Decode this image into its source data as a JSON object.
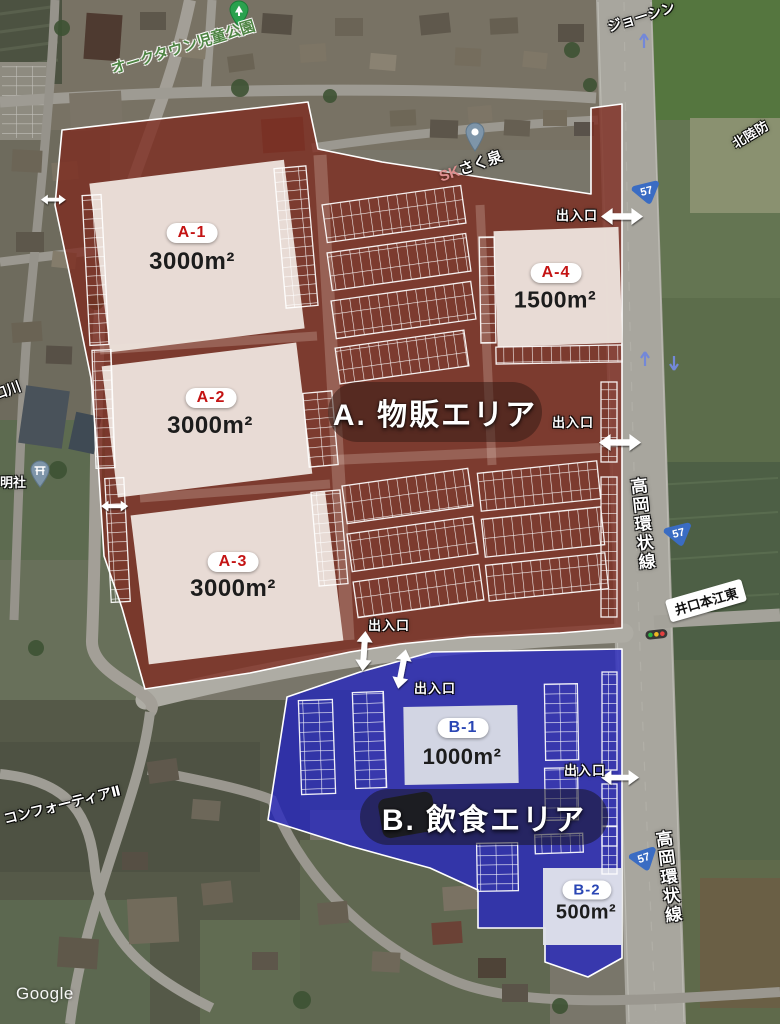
{
  "attribution": "Google",
  "entrance_label": "出入口",
  "route_shield": "57",
  "colors": {
    "zone_a_overlay": "#7e2a1f",
    "zone_b_overlay": "#2626c0",
    "shield_blue": "#3a6cc3",
    "zone_a_id_text": "#c41414",
    "zone_b_id_text": "#2a46b4"
  },
  "zone_a": {
    "name": "A. 物販エリア",
    "parcels": [
      {
        "id": "A-1",
        "area": "3000m²"
      },
      {
        "id": "A-2",
        "area": "3000m²"
      },
      {
        "id": "A-3",
        "area": "3000m²"
      },
      {
        "id": "A-4",
        "area": "1500m²"
      }
    ]
  },
  "zone_b": {
    "name": "B. 飲食エリア",
    "parcels": [
      {
        "id": "B-1",
        "area": "1000m²"
      },
      {
        "id": "B-2",
        "area": "500m²"
      }
    ]
  },
  "map_labels": {
    "park": "オークタウン児童公園",
    "store_north": "ジョーシン",
    "right_edge_partial": "北陸防",
    "well_prefix": "SK",
    "well_name": "さく泉",
    "ring_road_upper": "高岡環状線",
    "ring_road_lower": "高岡環状線",
    "intersection": "井口本江東",
    "residence_sw": "コンフォーティアⅡ",
    "shrine": "明社",
    "left_edge_partial": "口川"
  }
}
